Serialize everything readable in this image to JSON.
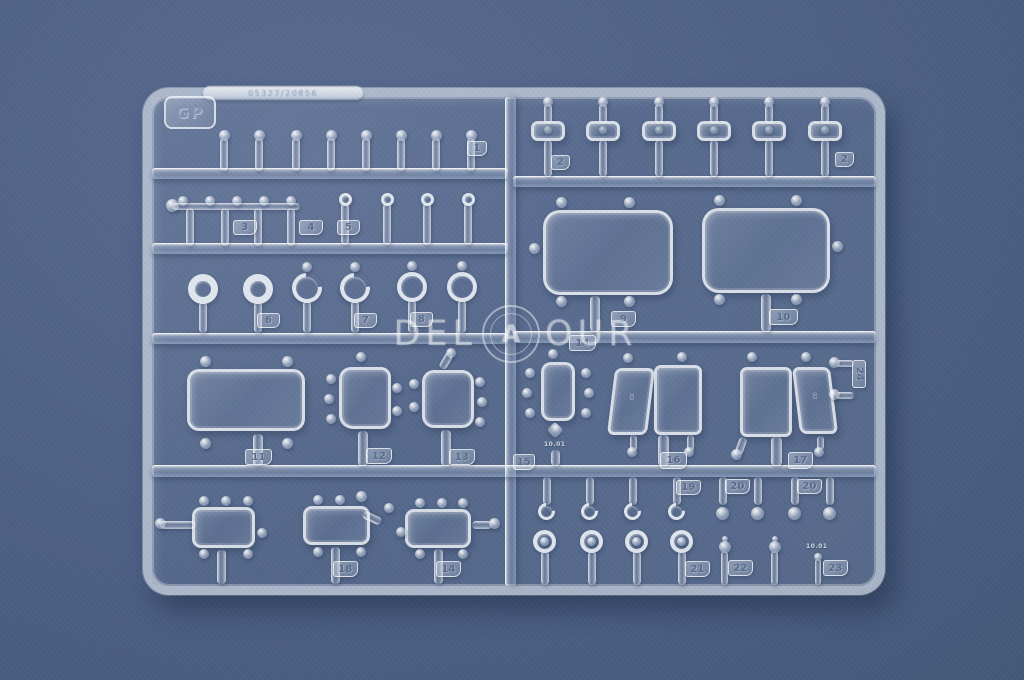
{
  "photo": {
    "subject": "clear-plastic-model-sprue",
    "colors": {
      "background": "#4f6387",
      "plastic_edge": "#f2f7fd",
      "tag_text": "#506586"
    }
  },
  "sprue": {
    "corner_label": "GP",
    "mold_code": "05327/20856",
    "mark_a": "10.01",
    "mark_b": "10.01",
    "pane_mark_16": "8",
    "pane_mark_17": "8"
  },
  "tags": {
    "t1": "1",
    "t2a": "2",
    "t2b": "2",
    "t3": "3",
    "t4": "4",
    "t5": "5",
    "t6": "6",
    "t7": "7",
    "t8": "8",
    "t9": "9",
    "t10": "10",
    "t11": "11",
    "t12": "12",
    "t13": "13",
    "t14c": "14",
    "t14b": "14",
    "t15": "15",
    "t16": "16",
    "t17": "17",
    "t18": "18",
    "t19": "19",
    "t20a": "20",
    "t20b": "20",
    "t21": "21",
    "t22": "22",
    "t23": "23",
    "t24": "24"
  },
  "watermark": {
    "left": "DEL",
    "right": "OUR",
    "monogram": "A"
  }
}
